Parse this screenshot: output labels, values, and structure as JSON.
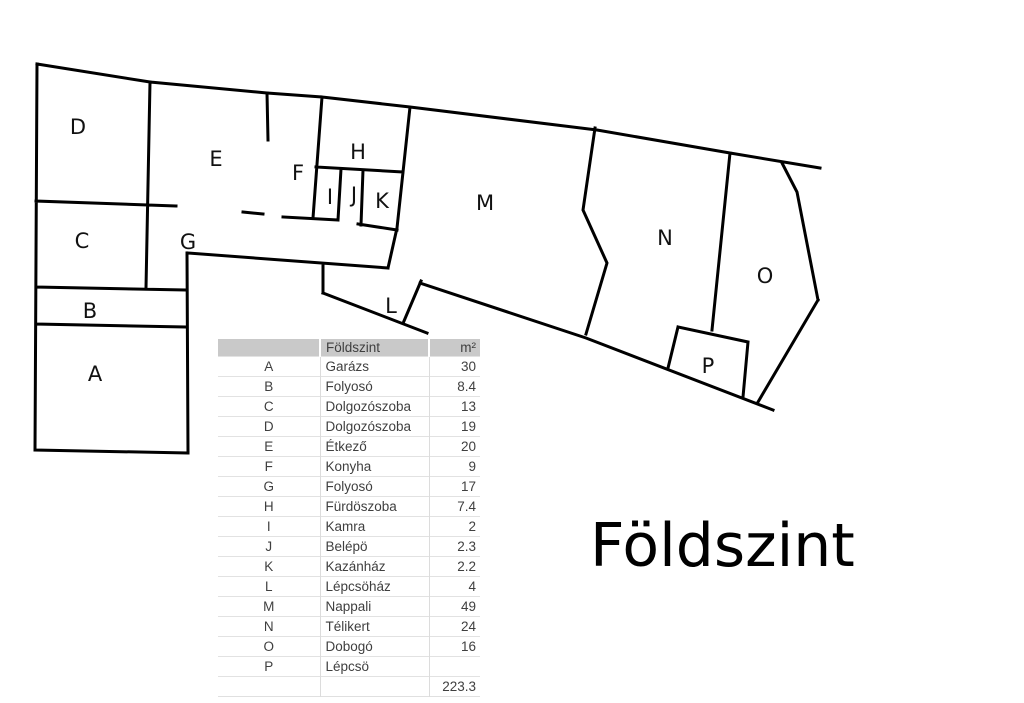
{
  "title": "Földszint",
  "plan": {
    "rooms": [
      {
        "letter": "A"
      },
      {
        "letter": "B"
      },
      {
        "letter": "C"
      },
      {
        "letter": "D"
      },
      {
        "letter": "E"
      },
      {
        "letter": "F"
      },
      {
        "letter": "G"
      },
      {
        "letter": "H"
      },
      {
        "letter": "I"
      },
      {
        "letter": "J"
      },
      {
        "letter": "K"
      },
      {
        "letter": "L"
      },
      {
        "letter": "M"
      },
      {
        "letter": "N"
      },
      {
        "letter": "O"
      },
      {
        "letter": "P"
      }
    ]
  },
  "table": {
    "headers": {
      "name": "Földszint",
      "area": "m²"
    },
    "rows": [
      {
        "letter": "A",
        "name": "Garázs",
        "area": "30"
      },
      {
        "letter": "B",
        "name": "Folyosó",
        "area": "8.4"
      },
      {
        "letter": "C",
        "name": "Dolgozószoba",
        "area": "13"
      },
      {
        "letter": "D",
        "name": "Dolgozószoba",
        "area": "19"
      },
      {
        "letter": "E",
        "name": "Étkező",
        "area": "20"
      },
      {
        "letter": "F",
        "name": "Konyha",
        "area": "9"
      },
      {
        "letter": "G",
        "name": "Folyosó",
        "area": "17"
      },
      {
        "letter": "H",
        "name": "Fürdöszoba",
        "area": "7.4"
      },
      {
        "letter": "I",
        "name": "Kamra",
        "area": "2"
      },
      {
        "letter": "J",
        "name": "Belépö",
        "area": "2.3"
      },
      {
        "letter": "K",
        "name": "Kazánház",
        "area": "2.2"
      },
      {
        "letter": "L",
        "name": "Lépcsöház",
        "area": "4"
      },
      {
        "letter": "M",
        "name": "Nappali",
        "area": "49"
      },
      {
        "letter": "N",
        "name": "Télikert",
        "area": "24"
      },
      {
        "letter": "O",
        "name": "Dobogó",
        "area": "16"
      },
      {
        "letter": "P",
        "name": "Lépcsö",
        "area": ""
      }
    ],
    "total": "223.3"
  }
}
